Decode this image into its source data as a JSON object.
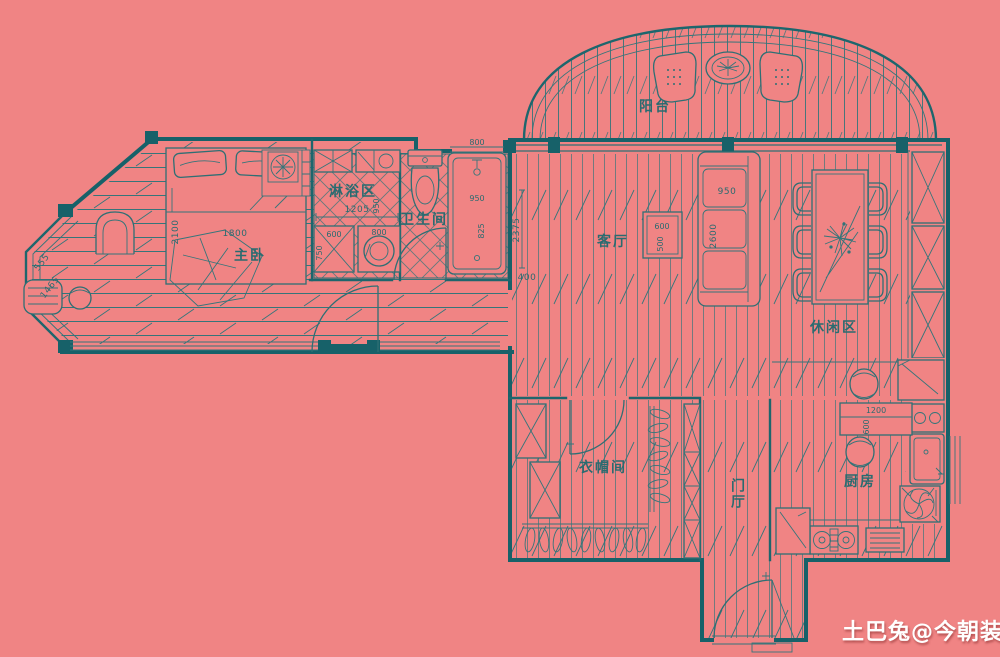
{
  "canvas": {
    "background": "#f08484",
    "line_color": "#2e6f74",
    "wall_color": "#176169",
    "watermark_color": "#ffffff"
  },
  "rooms": {
    "balcony": "阳台",
    "master_bedroom": "主卧",
    "shower": "淋浴区",
    "bathroom": "卫生间",
    "living": "客厅",
    "leisure": "休闲区",
    "cloakroom": "衣帽间",
    "hall": "门厅",
    "kitchen": "厨房"
  },
  "dims": {
    "bed_length": "2100",
    "bed_width": "1800",
    "bay_window_1": "555",
    "bay_window_2": "1465",
    "shower_width": "1205",
    "shower_depth": "950",
    "cabinet_width": "600",
    "cabinet_depth": "750",
    "washer_width": "800",
    "bath_window": "800",
    "tub_width": "950",
    "tub_length": "825",
    "living_wall": "2375",
    "living_wall_b": "400",
    "side_table_w": "600",
    "side_table_d": "500",
    "sofa_width": "950",
    "sofa_length": "2600",
    "kitchen_table_l": "1200",
    "kitchen_table_w": "600"
  },
  "watermark": "土巴兔@今朝装饰"
}
